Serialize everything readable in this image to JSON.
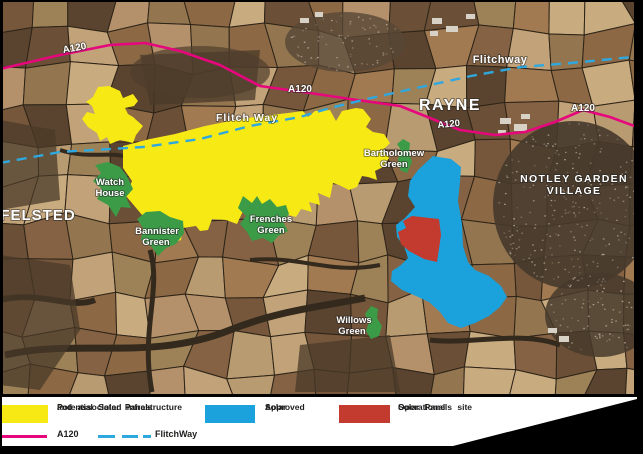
{
  "map": {
    "settlements": {
      "felsted": "FELSTED",
      "rayne": "RAYNE",
      "notley_line1": "NOTLEY GARDEN",
      "notley_line2": "VILLAGE"
    },
    "greens": {
      "watch_house": {
        "line1": "Watch",
        "line2": "House"
      },
      "bannister": {
        "line1": "Bannister",
        "line2": "Green"
      },
      "frenches": {
        "line1": "Frenches",
        "line2": "Green"
      },
      "bartholomew": {
        "line1": "Bartholomew",
        "line2": "Green"
      },
      "willows": {
        "line1": "Willows",
        "line2": "Green"
      }
    },
    "routes": {
      "a120_label_1": "A120",
      "a120_label_2": "A120",
      "a120_label_3": "A120",
      "a120_label_4": "A120",
      "flitch_way_label": "Flitch Way",
      "flitchway_label": "Flitchway"
    },
    "overlay_colors": {
      "potential_solar": "#F7E914",
      "approved_solar": "#1BA1DC",
      "operational_solar": "#C33B2E",
      "village_green": "#3C9B47",
      "a120_road": "#E6077D",
      "flitchway_line": "#2FA8DF"
    }
  },
  "legend": {
    "potential": {
      "line1": "Potential Solar Panels",
      "line2": "and associated infrastructure",
      "color": "#F7E914"
    },
    "approved": {
      "line1": "Approved",
      "line2": "Solar",
      "color": "#1BA1DC"
    },
    "operational": {
      "line1": "Operational",
      "line2": "Solar Panels site",
      "color": "#C33B2E"
    },
    "a120": {
      "label": "A120",
      "color": "#E6077D"
    },
    "flitchway": {
      "label": "FlitchWay",
      "color": "#2FA8DF"
    }
  }
}
